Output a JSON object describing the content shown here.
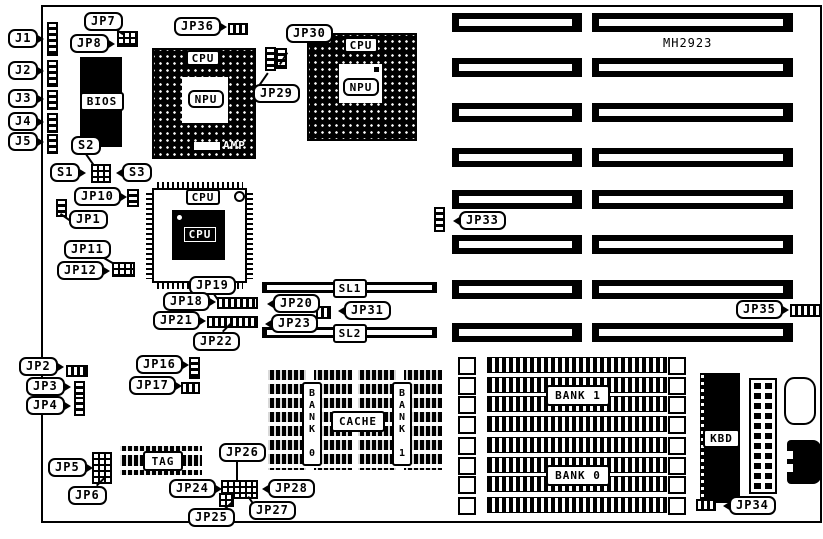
{
  "board": {
    "part_number": "MH2923"
  },
  "colors": {
    "ink": "#000000",
    "paper": "#ffffff"
  },
  "callouts": {
    "j1": "J1",
    "j2": "J2",
    "j3": "J3",
    "j4": "J4",
    "j5": "J5",
    "jp1": "JP1",
    "jp2": "JP2",
    "jp3": "JP3",
    "jp4": "JP4",
    "jp5": "JP5",
    "jp6": "JP6",
    "jp7": "JP7",
    "jp8": "JP8",
    "jp10": "JP10",
    "jp11": "JP11",
    "jp12": "JP12",
    "jp16": "JP16",
    "jp17": "JP17",
    "jp18": "JP18",
    "jp19": "JP19",
    "jp20": "JP20",
    "jp21": "JP21",
    "jp22": "JP22",
    "jp23": "JP23",
    "jp24": "JP24",
    "jp25": "JP25",
    "jp26": "JP26",
    "jp27": "JP27",
    "jp28": "JP28",
    "jp29": "JP29",
    "jp30": "JP30",
    "jp31": "JP31",
    "jp33": "JP33",
    "jp34": "JP34",
    "jp35": "JP35",
    "jp36": "JP36",
    "s1": "S1",
    "s2": "S2",
    "s3": "S3"
  },
  "chips": {
    "bios": "BIOS",
    "cpu": "CPU",
    "npu": "NPU",
    "amp": "AMP",
    "tag": "TAG",
    "cache": "CACHE",
    "kbd": "KBD"
  },
  "banks": {
    "cache_bank0": "BANK 0",
    "cache_bank1": "BANK 1",
    "simm_bank0": "BANK 0",
    "simm_bank1": "BANK 1"
  },
  "slots": {
    "sl1": "SL1",
    "sl2": "SL2"
  }
}
